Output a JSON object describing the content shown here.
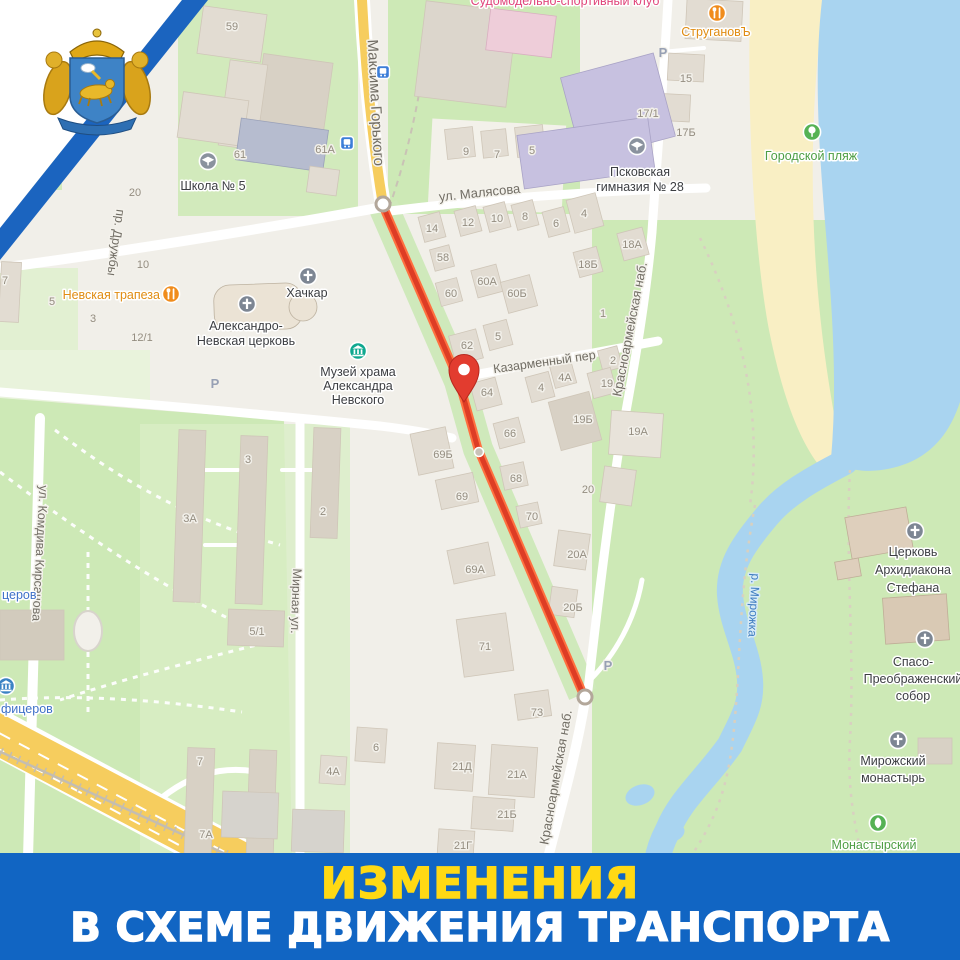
{
  "banner": {
    "line1": "ИЗМЕНЕНИЯ",
    "line2": "В СХЕМЕ ДВИЖЕНИЯ ТРАНСПОРТА",
    "bg_color": "#1165c3",
    "line1_color": "#ffd914",
    "line2_color": "#ffffff"
  },
  "frame": {
    "stripe_color": "#1b64bf",
    "wedge_color": "#ffffff"
  },
  "colors": {
    "map_base": "#f1efe9",
    "park_green": "#cde9b6",
    "pale_green": "#e2f0d2",
    "water": "#a9d4f0",
    "beach_sand": "#f9efc4",
    "road_white": "#ffffff",
    "road_yellow": "#f6cd5e",
    "route_red": "#dd3d25",
    "route_red_edge": "#ff7040",
    "building_fill": "#e2dcd2",
    "building_purple": "#c7c1e0",
    "building_blue": "#b6bccf"
  },
  "map": {
    "route": {
      "points": "383,206 459,381 478,449 583,694",
      "endpoints": [
        {
          "x": 383,
          "y": 204
        },
        {
          "x": 585,
          "y": 697
        }
      ],
      "waypoint_dot": {
        "x": 479,
        "y": 452
      },
      "pin": {
        "x": 464,
        "y": 371
      }
    },
    "street_labels": [
      {
        "t": "Максима Горького",
        "x": 371,
        "y": 103,
        "r": 87,
        "s": 15
      },
      {
        "t": "ул. Малясова",
        "x": 480,
        "y": 197,
        "r": -6,
        "s": 13
      },
      {
        "t": "пр. Дружбы",
        "x": 112,
        "y": 242,
        "r": 98,
        "s": 12.5
      },
      {
        "t": "ул. Комдива Кирсанова",
        "x": 36,
        "y": 553,
        "r": 93,
        "s": 12.5
      },
      {
        "t": "Мирная ул.",
        "x": 292,
        "y": 601,
        "r": 92,
        "s": 12.5
      },
      {
        "t": "Красноармейская наб.",
        "x": 634,
        "y": 330,
        "r": -79,
        "s": 13
      },
      {
        "t": "Красноармейская наб.",
        "x": 560,
        "y": 778,
        "r": -80,
        "s": 13
      },
      {
        "t": "Казарменный пер",
        "x": 545,
        "y": 366,
        "r": -8,
        "s": 12.5
      },
      {
        "t": "р. Мирожка",
        "x": 750,
        "y": 605,
        "r": 93,
        "s": 12,
        "water": true
      }
    ],
    "house_numbers": [
      {
        "t": "59А",
        "x": 118,
        "y": 33
      },
      {
        "t": "59",
        "x": 232,
        "y": 30
      },
      {
        "t": "61",
        "x": 240,
        "y": 158
      },
      {
        "t": "61А",
        "x": 325,
        "y": 153
      },
      {
        "t": "20",
        "x": 135,
        "y": 196
      },
      {
        "t": "10",
        "x": 143,
        "y": 268
      },
      {
        "t": "7",
        "x": 5,
        "y": 284
      },
      {
        "t": "5",
        "x": 52,
        "y": 305
      },
      {
        "t": "3",
        "x": 93,
        "y": 322
      },
      {
        "t": "12/1",
        "x": 142,
        "y": 341
      },
      {
        "t": "9",
        "x": 466,
        "y": 155
      },
      {
        "t": "7",
        "x": 497,
        "y": 158
      },
      {
        "t": "5",
        "x": 532,
        "y": 154
      },
      {
        "t": "15",
        "x": 686,
        "y": 82
      },
      {
        "t": "17/1",
        "x": 648,
        "y": 117
      },
      {
        "t": "17Б",
        "x": 686,
        "y": 136
      },
      {
        "t": "14",
        "x": 432,
        "y": 232
      },
      {
        "t": "12",
        "x": 468,
        "y": 226
      },
      {
        "t": "10",
        "x": 497,
        "y": 222
      },
      {
        "t": "8",
        "x": 525,
        "y": 220
      },
      {
        "t": "6",
        "x": 556,
        "y": 227
      },
      {
        "t": "4",
        "x": 584,
        "y": 217
      },
      {
        "t": "18А",
        "x": 632,
        "y": 248
      },
      {
        "t": "58",
        "x": 443,
        "y": 261
      },
      {
        "t": "18Б",
        "x": 588,
        "y": 268
      },
      {
        "t": "60А",
        "x": 487,
        "y": 285
      },
      {
        "t": "60Б",
        "x": 517,
        "y": 297
      },
      {
        "t": "60",
        "x": 451,
        "y": 297
      },
      {
        "t": "62",
        "x": 467,
        "y": 349
      },
      {
        "t": "5",
        "x": 498,
        "y": 340
      },
      {
        "t": "64",
        "x": 487,
        "y": 396
      },
      {
        "t": "4",
        "x": 541,
        "y": 391
      },
      {
        "t": "4А",
        "x": 565,
        "y": 381
      },
      {
        "t": "2",
        "x": 613,
        "y": 364
      },
      {
        "t": "19",
        "x": 607,
        "y": 387
      },
      {
        "t": "1",
        "x": 603,
        "y": 317
      },
      {
        "t": "19Б",
        "x": 583,
        "y": 423
      },
      {
        "t": "66",
        "x": 510,
        "y": 437
      },
      {
        "t": "19А",
        "x": 638,
        "y": 435
      },
      {
        "t": "69Б",
        "x": 443,
        "y": 458
      },
      {
        "t": "69",
        "x": 462,
        "y": 500
      },
      {
        "t": "68",
        "x": 516,
        "y": 482
      },
      {
        "t": "20",
        "x": 588,
        "y": 493
      },
      {
        "t": "70",
        "x": 532,
        "y": 520
      },
      {
        "t": "20А",
        "x": 577,
        "y": 558
      },
      {
        "t": "69А",
        "x": 475,
        "y": 573
      },
      {
        "t": "20Б",
        "x": 573,
        "y": 611
      },
      {
        "t": "71",
        "x": 485,
        "y": 650
      },
      {
        "t": "73",
        "x": 537,
        "y": 716
      },
      {
        "t": "21Д",
        "x": 462,
        "y": 770
      },
      {
        "t": "21А",
        "x": 517,
        "y": 778
      },
      {
        "t": "21Б",
        "x": 507,
        "y": 818
      },
      {
        "t": "21Г",
        "x": 463,
        "y": 849
      },
      {
        "t": "3А",
        "x": 190,
        "y": 522
      },
      {
        "t": "3",
        "x": 248,
        "y": 463
      },
      {
        "t": "2",
        "x": 323,
        "y": 515
      },
      {
        "t": "5/1",
        "x": 257,
        "y": 635
      },
      {
        "t": "7",
        "x": 200,
        "y": 765
      },
      {
        "t": "7А",
        "x": 206,
        "y": 838
      },
      {
        "t": "4А",
        "x": 333,
        "y": 775
      },
      {
        "t": "6",
        "x": 376,
        "y": 751
      }
    ],
    "place_labels": [
      {
        "lines": [
          "Школа № 5"
        ],
        "x": 213,
        "y": 190,
        "color": "#3c3e42"
      },
      {
        "lines": [
          "Псковская",
          "гимназия № 28"
        ],
        "x": 640,
        "y": 176,
        "lh": 15,
        "color": "#3c3e42"
      },
      {
        "lines": [
          "Невская трапеза"
        ],
        "x": 160,
        "y": 299,
        "color": "#e08c12",
        "anchor": "end",
        "size": 13
      },
      {
        "lines": [
          "Хачкар"
        ],
        "x": 307,
        "y": 297,
        "color": "#3c3e42"
      },
      {
        "lines": [
          "Александро-",
          "Невская церковь"
        ],
        "x": 246,
        "y": 330,
        "lh": 15,
        "color": "#3c3e42"
      },
      {
        "lines": [
          "Музей храма",
          "Александра",
          "Невского"
        ],
        "x": 358,
        "y": 376,
        "lh": 14,
        "color": "#3c3e42"
      },
      {
        "lines": [
          "СтругановЪ"
        ],
        "x": 716,
        "y": 36,
        "color": "#e08c12",
        "size": 13
      },
      {
        "lines": [
          "Городской пляж"
        ],
        "x": 811,
        "y": 160,
        "color": "#4e9e44",
        "size": 13
      },
      {
        "lines": [
          "Церковь",
          "Архидиакона",
          "Стефана"
        ],
        "x": 913,
        "y": 556,
        "lh": 18,
        "color": "#3c3e42",
        "size": 13
      },
      {
        "lines": [
          "Спасо-",
          "Преображенский",
          "собор"
        ],
        "x": 913,
        "y": 666,
        "lh": 17,
        "color": "#3c3e42",
        "size": 13
      },
      {
        "lines": [
          "Мирожский",
          "монастырь"
        ],
        "x": 893,
        "y": 765,
        "lh": 17,
        "color": "#3c3e42",
        "size": 13
      },
      {
        "lines": [
          "Монастырский"
        ],
        "x": 874,
        "y": 849,
        "color": "#4e9e44",
        "size": 12.5
      },
      {
        "lines": [
          "церов"
        ],
        "x": 2,
        "y": 599,
        "color": "#3f71c8",
        "anchor": "start"
      },
      {
        "lines": [
          "фицеров"
        ],
        "x": 1,
        "y": 713,
        "color": "#3f71c8",
        "anchor": "start"
      },
      {
        "lines": [
          "Судомодельно-спортивный клуб"
        ],
        "x": 565,
        "y": 5,
        "color": "#e0457b",
        "size": 12
      }
    ],
    "poi_icons": [
      {
        "type": "school",
        "x": 208,
        "y": 161,
        "c": "#8a929e"
      },
      {
        "type": "school",
        "x": 637,
        "y": 146,
        "c": "#8a929e"
      },
      {
        "type": "food",
        "x": 171,
        "y": 294,
        "c": "#f08c1c"
      },
      {
        "type": "cross",
        "x": 247,
        "y": 304,
        "c": "#7d8693"
      },
      {
        "type": "cross",
        "x": 308,
        "y": 276,
        "c": "#7d8693"
      },
      {
        "type": "museum",
        "x": 358,
        "y": 351,
        "c": "#0fa88f"
      },
      {
        "type": "food",
        "x": 717,
        "y": 13,
        "c": "#f08c1c"
      },
      {
        "type": "tree",
        "x": 812,
        "y": 132,
        "c": "#55b254"
      },
      {
        "type": "cross",
        "x": 915,
        "y": 531,
        "c": "#7d8693"
      },
      {
        "type": "cross",
        "x": 925,
        "y": 639,
        "c": "#7d8693"
      },
      {
        "type": "cross",
        "x": 898,
        "y": 740,
        "c": "#7d8693"
      },
      {
        "type": "leaf",
        "x": 878,
        "y": 823,
        "c": "#55b254"
      },
      {
        "type": "museum",
        "x": 6,
        "y": 686,
        "c": "#3b82c4"
      }
    ],
    "parking_label": "Р",
    "parking_spots": [
      {
        "x": 663,
        "y": 57
      },
      {
        "x": 215,
        "y": 388
      },
      {
        "x": 608,
        "y": 670
      }
    ],
    "transit_stops": [
      {
        "x": 383,
        "y": 72
      },
      {
        "x": 347,
        "y": 143
      }
    ]
  }
}
